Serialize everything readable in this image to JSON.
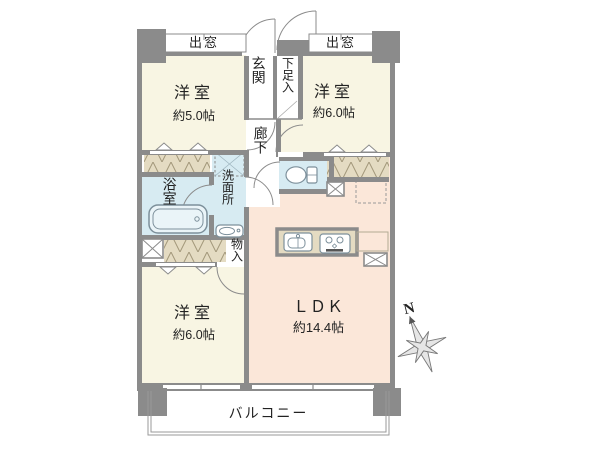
{
  "plan": {
    "bay_window_left": "出窓",
    "bay_window_right": "出窓",
    "entrance": "玄関",
    "shoe_storage": "下足入",
    "corridor": "廊下",
    "bath": "浴室",
    "washroom": "洗面所",
    "storage": "物入",
    "balcony": "バルコニー",
    "rooms": {
      "top_left": {
        "name": "洋室",
        "size": "約5.0帖"
      },
      "top_right": {
        "name": "洋室",
        "size": "約6.0帖"
      },
      "bottom_left": {
        "name": "洋室",
        "size": "約6.0帖"
      },
      "ldk": {
        "name": "ＬＤＫ",
        "size": "約14.4帖"
      }
    },
    "compass": {
      "north": "N"
    },
    "colors": {
      "wall": "#8b8b8b",
      "room_cream": "#f8f5e3",
      "ldk_pink": "#fbe7d9",
      "water_blue": "#d7ebf2",
      "closet_beige": "#e4dbc2"
    }
  }
}
